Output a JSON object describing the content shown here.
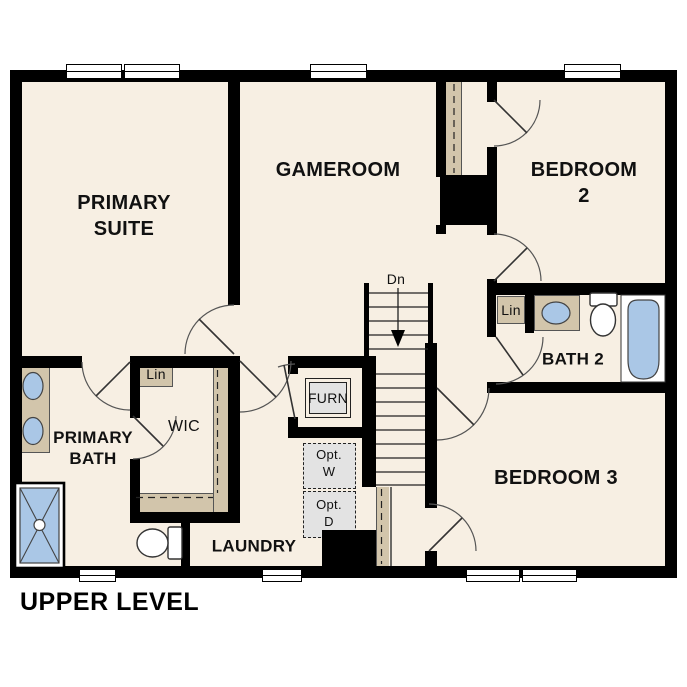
{
  "plan_title": "UPPER LEVEL",
  "colors": {
    "background": "#FFFFFF",
    "floor": "#F7EFE3",
    "wall": "#000000",
    "cabinet_tan": "#D2C5AB",
    "fixture_blue": "#AAC7E6",
    "appliance_gray": "#E3E3E3"
  },
  "rooms": {
    "primary_suite": {
      "label": "PRIMARY\nSUITE"
    },
    "gameroom": {
      "label": "GAMEROOM"
    },
    "bedroom2": {
      "label": "BEDROOM 2"
    },
    "bath2": {
      "label": "BATH 2"
    },
    "bedroom3": {
      "label": "BEDROOM 3"
    },
    "primary_bath": {
      "label": "PRIMARY\nBATH"
    },
    "wic": {
      "label": "WIC"
    },
    "laundry": {
      "label": "LAUNDRY"
    }
  },
  "closets": {
    "linen_wic": {
      "label": "Lin"
    },
    "linen_bath2": {
      "label": "Lin"
    },
    "furnace": {
      "label": "FURN"
    }
  },
  "appliances": {
    "optional_washer": {
      "label": "Opt.\nW"
    },
    "optional_dryer": {
      "label": "Opt.\nD"
    }
  },
  "stairs": {
    "direction_label": "Dn"
  }
}
